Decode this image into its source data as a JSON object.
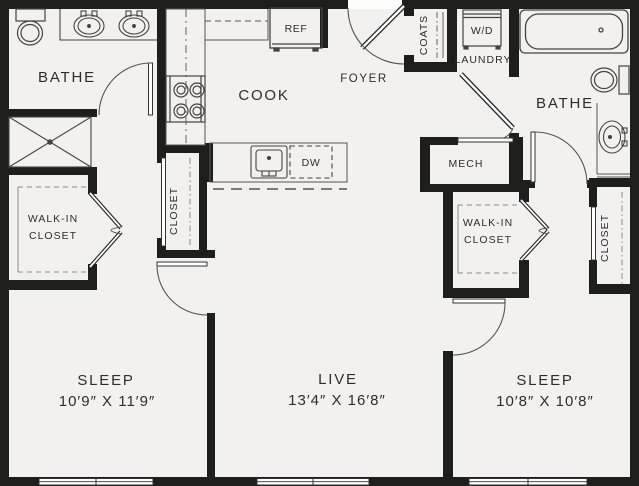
{
  "plan_title": "Two-bedroom apartment floor plan",
  "colors": {
    "wall": "#1e1e1c",
    "floor": "#f2f1ef",
    "thin_line": "#4d4d4b",
    "arc_line": "#55554f",
    "text": "#2d2d2b",
    "background": "#fdfdfc"
  },
  "rooms": {
    "bath1": {
      "label": "BATHE"
    },
    "cook": {
      "label": "COOK"
    },
    "foyer": {
      "label": "FOYER"
    },
    "coats": {
      "label": "COATS"
    },
    "laundry": {
      "label": "LAUNDRY"
    },
    "bath2": {
      "label": "BATHE"
    },
    "mech": {
      "label": "MECH"
    },
    "walkin_left": {
      "line1": "WALK-IN",
      "line2": "CLOSET"
    },
    "walkin_right": {
      "line1": "WALK-IN",
      "line2": "CLOSET"
    },
    "hall_closet": {
      "label": "CLOSET"
    },
    "bedroom_closet": {
      "label": "CLOSET"
    },
    "sleep1": {
      "label": "SLEEP",
      "dims": "10′9″ X 11′9″"
    },
    "live": {
      "label": "LIVE",
      "dims": "13′4″ X 16′8″"
    },
    "sleep2": {
      "label": "SLEEP",
      "dims": "10′8″ X 10′8″"
    }
  },
  "appliances": {
    "refrigerator": "REF",
    "washer_dryer": "W/D",
    "dishwasher": "DW"
  }
}
